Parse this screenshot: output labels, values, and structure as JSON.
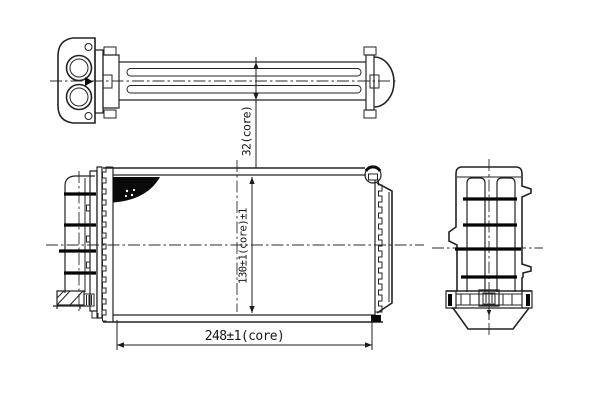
{
  "drawing": {
    "type": "technical-orthographic-drawing",
    "subject": "heater-core-radiator",
    "views": [
      "top-view",
      "front-view",
      "side-view"
    ],
    "dimensions": {
      "core_depth": "32(core)",
      "core_height": "130±1(core)±1",
      "core_length": "248±1(core)"
    }
  },
  "colors": {
    "background": "#ffffff",
    "line": "#232323",
    "thick_bar": "#050505",
    "fill_black": "#0a0a0a"
  }
}
